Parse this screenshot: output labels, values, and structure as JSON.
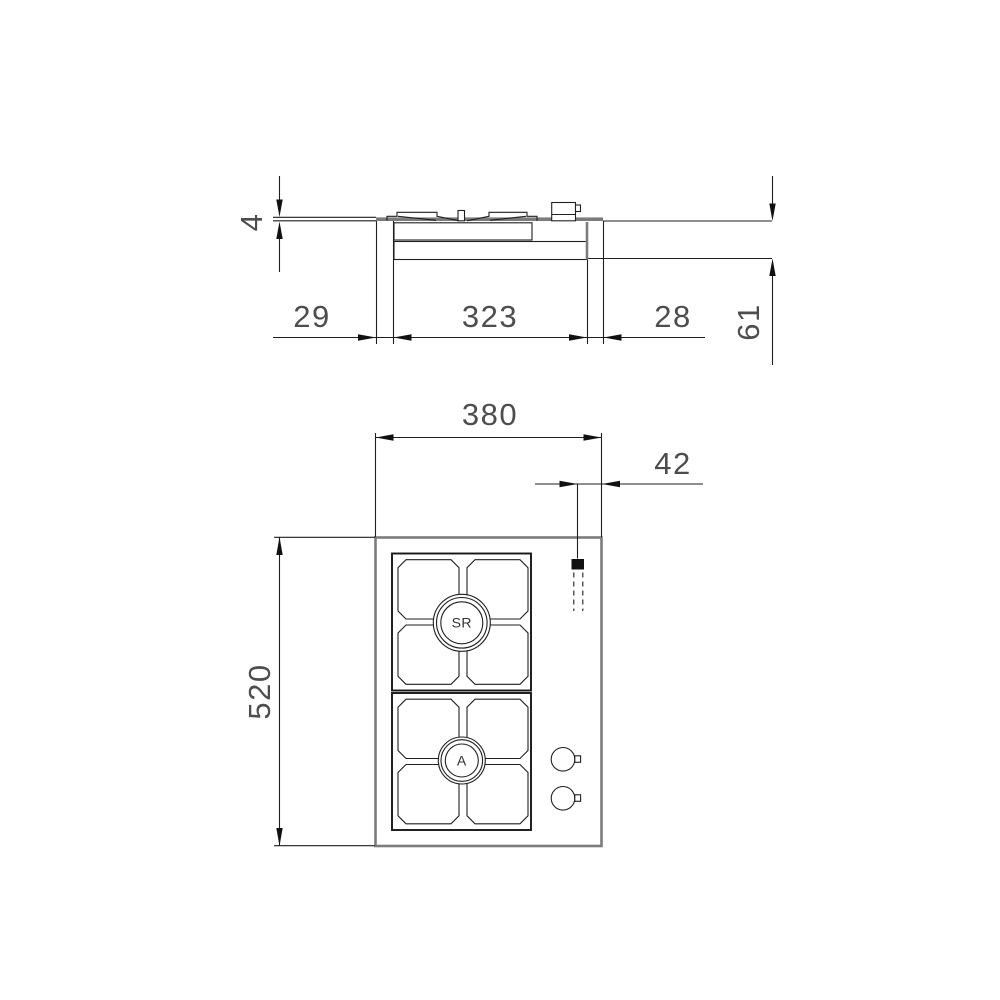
{
  "drawing": {
    "type": "installation-dimension-drawing",
    "views": [
      "side-section",
      "top-plan"
    ]
  },
  "colors": {
    "background": "#ffffff",
    "line": "#1f1f1f",
    "hob_outline_gray": "#7c7c7c",
    "dimension_text": "#4d4d4d",
    "gas_inlet_fill": "#111111"
  },
  "side_view": {
    "dims": {
      "plate_thickness": "4",
      "left_overhang": "29",
      "cutout_width": "323",
      "right_overhang": "28",
      "depth_below_worktop": "61"
    }
  },
  "top_view": {
    "dims": {
      "overall_width": "380",
      "gas_connection_offset": "42",
      "overall_depth": "520"
    },
    "burners": {
      "rear_burner_label": "SR",
      "front_burner_label": "A"
    },
    "markers": {
      "gas_inlet": "gas-inlet-marker",
      "knob_count": 2
    }
  }
}
